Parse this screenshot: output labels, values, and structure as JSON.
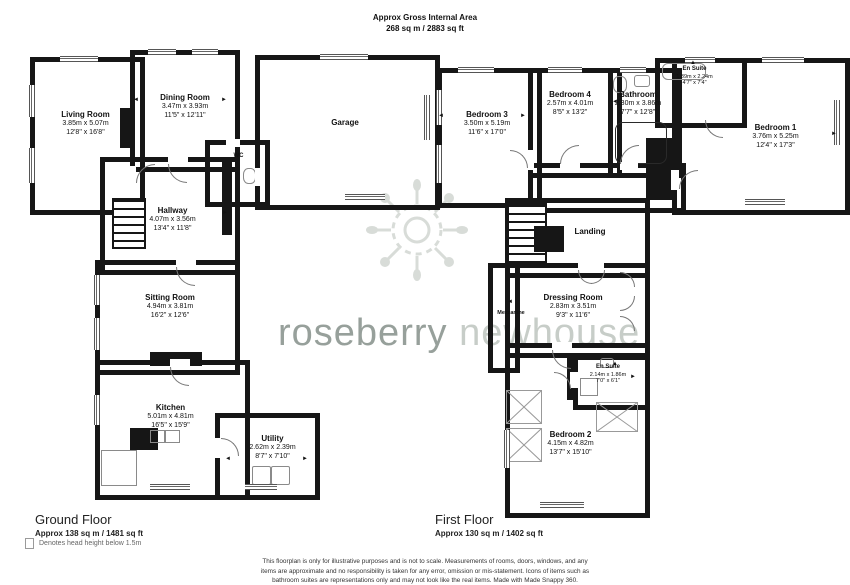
{
  "header": {
    "title": "Approx Gross Internal Area",
    "area": "268 sq m / 2883 sq ft"
  },
  "watermark": {
    "word1": "roseberry",
    "word2": "newhouse"
  },
  "icons": {
    "arrow_left": "◄",
    "arrow_right": "►",
    "arrow_up": "▲"
  },
  "colors": {
    "wall": "#161616",
    "watermark_dark": "#97a09b",
    "watermark_light": "#c7cdc8",
    "made_snappy_blue": "#2bb3e6"
  },
  "ground_floor": {
    "label": "Ground Floor",
    "area": "Approx 138 sq m / 1481 sq ft",
    "rooms": [
      {
        "name": "Living Room",
        "metric": "3.85m x 5.07m",
        "imperial": "12'8\" x 16'8\""
      },
      {
        "name": "Dining Room",
        "metric": "3.47m x 3.93m",
        "imperial": "11'5\" x 12'11\""
      },
      {
        "name": "Garage",
        "metric": "",
        "imperial": ""
      },
      {
        "name": "WC",
        "metric": "",
        "imperial": ""
      },
      {
        "name": "Hallway",
        "metric": "4.07m x 3.56m",
        "imperial": "13'4\" x 11'8\""
      },
      {
        "name": "Sitting Room",
        "metric": "4.94m x 3.81m",
        "imperial": "16'2\" x 12'6\""
      },
      {
        "name": "Kitchen",
        "metric": "5.01m x 4.81m",
        "imperial": "16'5\" x 15'9\""
      },
      {
        "name": "Utility",
        "metric": "2.62m x 2.39m",
        "imperial": "8'7\" x 7'10\""
      }
    ]
  },
  "first_floor": {
    "label": "First Floor",
    "area": "Approx 130 sq m / 1402 sq ft",
    "rooms": [
      {
        "name": "Bedroom 3",
        "metric": "3.50m x 5.19m",
        "imperial": "11'6\" x 17'0\""
      },
      {
        "name": "Bedroom 4",
        "metric": "2.57m x 4.01m",
        "imperial": "8'5\" x 13'2\""
      },
      {
        "name": "Bathroom",
        "metric": "2.30m x 3.86m",
        "imperial": "7'7\" x 12'8\""
      },
      {
        "name": "En Suite",
        "metric": "1.39m x 2.24m",
        "imperial": "4'7\" x 7'4\""
      },
      {
        "name": "Bedroom 1",
        "metric": "3.76m x 5.25m",
        "imperial": "12'4\" x 17'3\""
      },
      {
        "name": "Landing",
        "metric": "",
        "imperial": ""
      },
      {
        "name": "Dressing Room",
        "metric": "2.83m x 3.51m",
        "imperial": "9'3\" x 11'6\""
      },
      {
        "name": "Mezzanine",
        "metric": "",
        "imperial": ""
      },
      {
        "name": "En Suite",
        "metric": "2.14m x 1.86m",
        "imperial": "7'0\" x 6'1\""
      },
      {
        "name": "Bedroom 2",
        "metric": "4.15m x 4.82m",
        "imperial": "13'7\" x 15'10\""
      }
    ]
  },
  "legend": {
    "head_height": "Denotes head height below 1.5m"
  },
  "disclaimer": "This floorplan is only for illustrative purposes and is not to scale. Measurements of rooms, doors, windows, and any items are approximate and no responsibility is taken for any error, omission or mis-statement. Icons of items such as bathroom suites are representations only and may not look like the real items. Made with Made Snappy 360."
}
